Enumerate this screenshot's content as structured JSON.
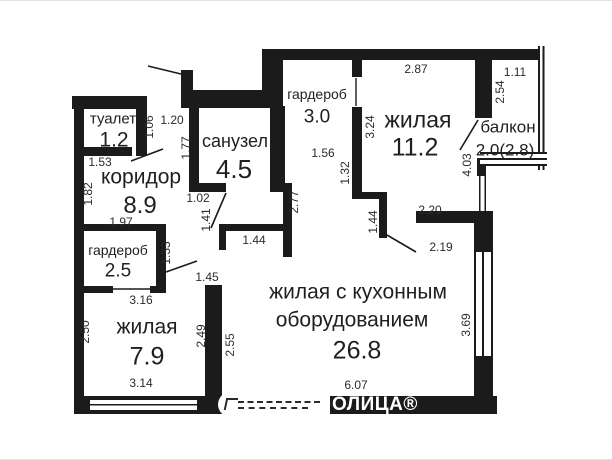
{
  "page_title": "План квартиры",
  "colors": {
    "wall": "#1b1b1b",
    "room_text": "#1f1f1f",
    "dim_text": "#2b2b2b",
    "background": "#ffffff"
  },
  "watermark": {
    "text": "ОЛИЦА®"
  },
  "plan": {
    "rooms": [
      {
        "name": "туалет",
        "area": "1.2",
        "name_pos": [
          113,
          119
        ],
        "name_size": 15,
        "area_pos": [
          114,
          140
        ],
        "area_size": 21
      },
      {
        "name": "коридор",
        "area": "8.9",
        "name_pos": [
          141,
          177
        ],
        "name_size": 21,
        "area_pos": [
          140,
          206
        ],
        "area_size": 24
      },
      {
        "name": "санузел",
        "area": "4.5",
        "name_pos": [
          235,
          141
        ],
        "name_size": 18,
        "area_pos": [
          234,
          169
        ],
        "area_size": 26
      },
      {
        "name": "гардероб",
        "area": "3.0",
        "name_pos": [
          317,
          94
        ],
        "name_size": 14,
        "area_pos": [
          317,
          117
        ],
        "area_size": 19
      },
      {
        "name": "жилая",
        "area": "11.2",
        "name_pos": [
          418,
          120
        ],
        "name_size": 23,
        "area_pos": [
          415,
          148
        ],
        "area_size": 25
      },
      {
        "name": "балкон",
        "area": "2.0(2.8)",
        "name_pos": [
          508,
          127
        ],
        "name_size": 17,
        "area_pos": [
          505,
          150
        ],
        "area_size": 17
      },
      {
        "name": "гардероб",
        "area": "2.5",
        "name_pos": [
          118,
          250
        ],
        "name_size": 14,
        "area_pos": [
          118,
          271
        ],
        "area_size": 19
      },
      {
        "name": "жилая",
        "area": "7.9",
        "name_pos": [
          147,
          327
        ],
        "name_size": 21,
        "area_pos": [
          147,
          357
        ],
        "area_size": 25
      },
      {
        "name": "жилая с кухонным оборудованием",
        "area": "26.8",
        "name_lines": [
          [
            "жилая с кухонным",
            358,
            292
          ],
          [
            "оборудованием",
            352,
            320
          ]
        ],
        "name_size": 21,
        "area_pos": [
          357,
          351
        ],
        "area_size": 25
      }
    ],
    "dimensions": [
      {
        "v": "1.20",
        "x": 172,
        "y": 120,
        "rot": 0
      },
      {
        "v": "1.06",
        "x": 149,
        "y": 127,
        "rot": 1
      },
      {
        "v": "1.53",
        "x": 100,
        "y": 162,
        "rot": 0
      },
      {
        "v": "1.77",
        "x": 186,
        "y": 148,
        "rot": 1
      },
      {
        "v": "1.82",
        "x": 88,
        "y": 194,
        "rot": 1
      },
      {
        "v": "1.02",
        "x": 198,
        "y": 198,
        "rot": 0
      },
      {
        "v": "1.41",
        "x": 206,
        "y": 220,
        "rot": 1
      },
      {
        "v": "1.97",
        "x": 121,
        "y": 222,
        "rot": 0
      },
      {
        "v": "1.44",
        "x": 254,
        "y": 240,
        "rot": 0
      },
      {
        "v": "1.33",
        "x": 166,
        "y": 253,
        "rot": 1
      },
      {
        "v": "1.45",
        "x": 207,
        "y": 277,
        "rot": 0
      },
      {
        "v": "3.16",
        "x": 141,
        "y": 300,
        "rot": 0
      },
      {
        "v": "2.50",
        "x": 85,
        "y": 332,
        "rot": 1
      },
      {
        "v": "2.49",
        "x": 201,
        "y": 336,
        "rot": 1
      },
      {
        "v": "2.55",
        "x": 230,
        "y": 345,
        "rot": 1
      },
      {
        "v": "3.14",
        "x": 141,
        "y": 383,
        "rot": 0
      },
      {
        "v": "2.77",
        "x": 294,
        "y": 202,
        "rot": 1
      },
      {
        "v": "1.56",
        "x": 323,
        "y": 153,
        "rot": 0
      },
      {
        "v": "1.32",
        "x": 345,
        "y": 173,
        "rot": 1
      },
      {
        "v": "1.44",
        "x": 373,
        "y": 222,
        "rot": 1
      },
      {
        "v": "3.24",
        "x": 370,
        "y": 127,
        "rot": 1
      },
      {
        "v": "2.87",
        "x": 416,
        "y": 69,
        "rot": 0
      },
      {
        "v": "1.11",
        "x": 515,
        "y": 72,
        "rot": 0
      },
      {
        "v": "2.54",
        "x": 500,
        "y": 92,
        "rot": 1
      },
      {
        "v": "4.03",
        "x": 467,
        "y": 165,
        "rot": 1
      },
      {
        "v": "2.20",
        "x": 430,
        "y": 210,
        "rot": 0
      },
      {
        "v": "2.19",
        "x": 441,
        "y": 247,
        "rot": 0
      },
      {
        "v": "6.07",
        "x": 356,
        "y": 385,
        "rot": 0
      },
      {
        "v": "3.69",
        "x": 466,
        "y": 325,
        "rot": 1
      }
    ]
  }
}
